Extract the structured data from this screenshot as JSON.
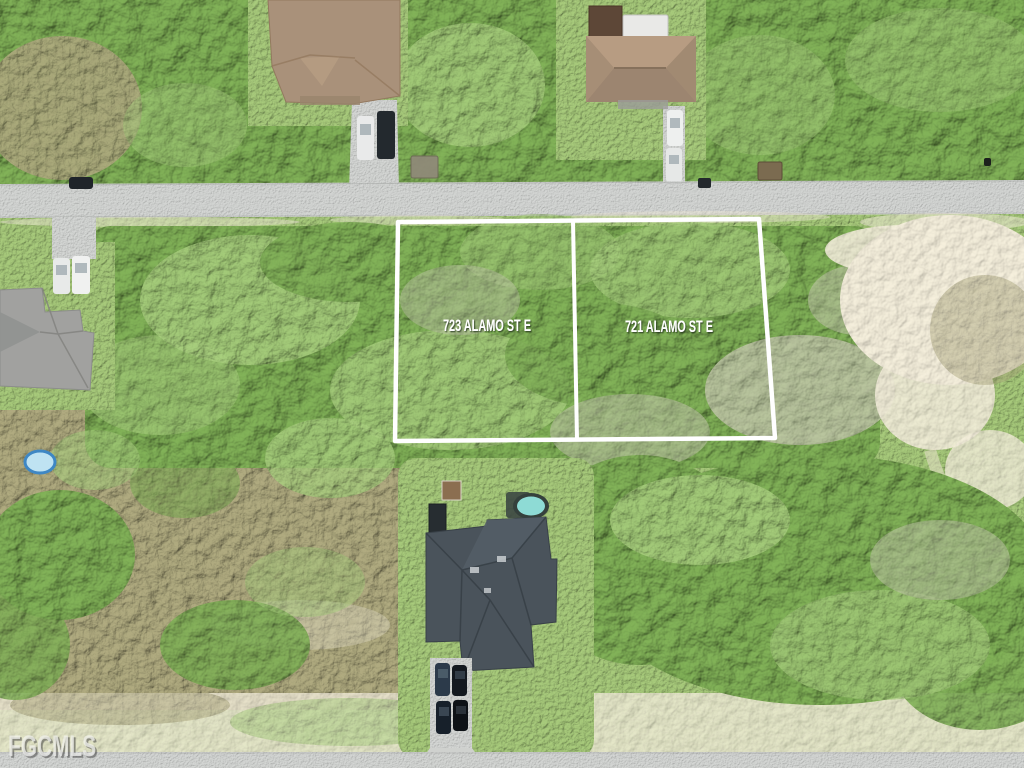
{
  "image": {
    "watermark": {
      "text": "FGCMLS",
      "color": "#f6f6f3"
    },
    "lots": [
      {
        "label": "723 ALAMO ST E"
      },
      {
        "label": "721 ALAMO ST E"
      }
    ],
    "boundary": {
      "color": "#ffffff"
    },
    "label_color": "#ffffff"
  },
  "palette": {
    "road": "#b9bbb9",
    "grass": "#8fae67",
    "trees_dark": "#648c44",
    "trees_light": "#8fb468",
    "dead_trees": "#aab894",
    "brush": "#8f8c67",
    "sand": "#ddd6c2",
    "roof_tan": "#a9917a",
    "roof_gray": "#a1a19f",
    "roof_charcoal": "#4a535b",
    "pool_water": "#8edbd5",
    "kiddie_pool": "#bfe3f2"
  }
}
